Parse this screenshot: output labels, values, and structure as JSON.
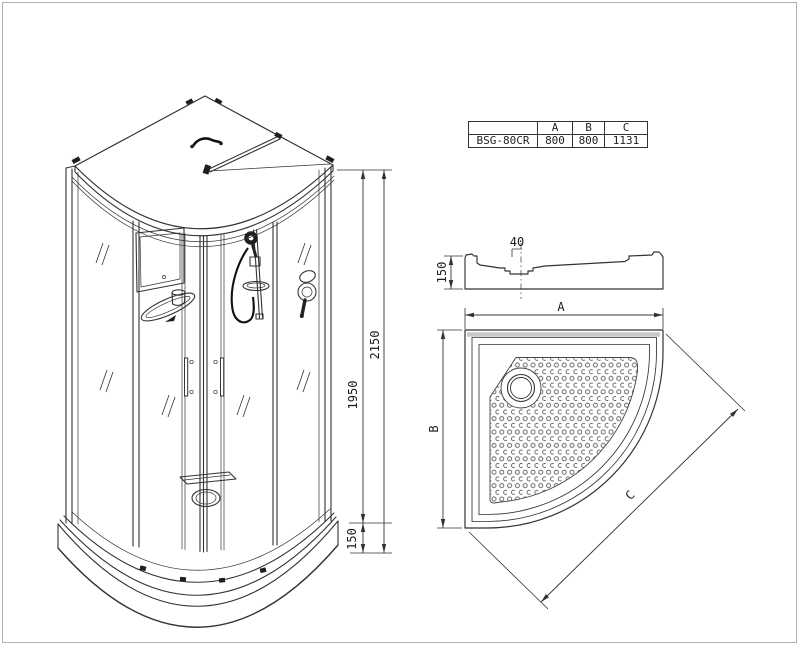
{
  "page": {
    "background": "#ffffff",
    "frame_color": "#b0b0b0",
    "line_color": "#333333",
    "shade_color": "#c9c9c9"
  },
  "spec_table": {
    "header_empty": "",
    "model": "BSG-80CR",
    "columns": [
      "A",
      "B",
      "C"
    ],
    "values": [
      "800",
      "800",
      "1131"
    ]
  },
  "cabin_view": {
    "total_height": "2150",
    "glass_height": "1950",
    "tray_height": "150"
  },
  "section_view": {
    "drain_width": "40",
    "tray_height": "150"
  },
  "plan_view": {
    "width_label": "A",
    "depth_label": "B",
    "diagonal_label": "C"
  }
}
